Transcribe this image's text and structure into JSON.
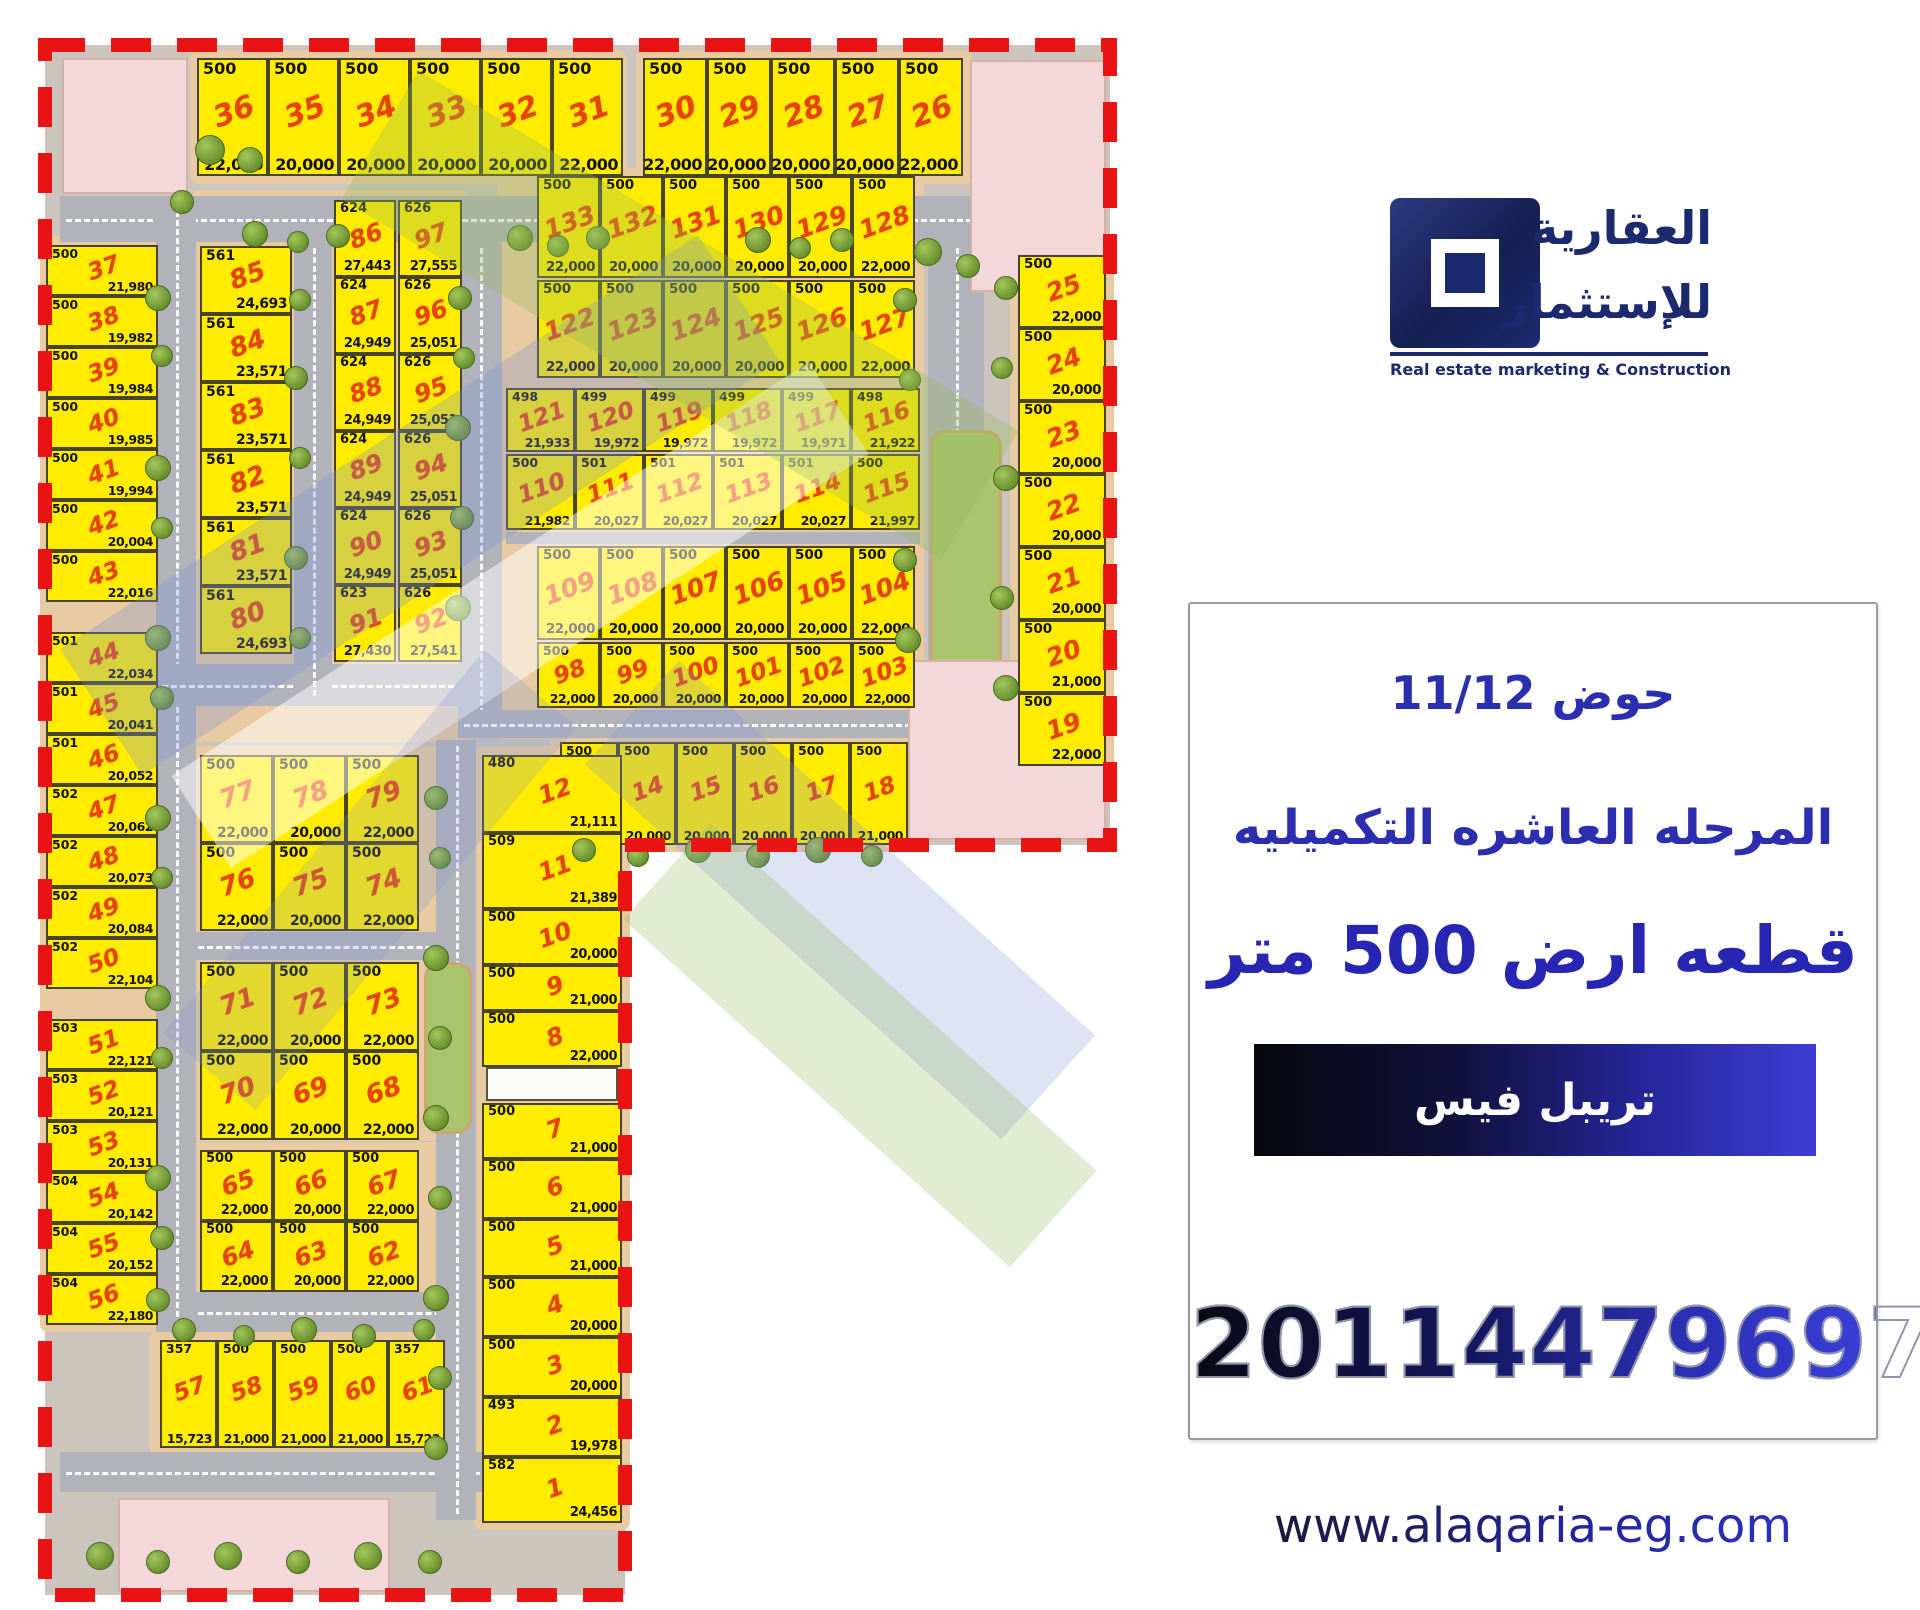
{
  "logo": {
    "arabic_line1": "العقارية",
    "arabic_line2": "للإستثمار",
    "subtitle": "Real estate marketing & Construction"
  },
  "panel": {
    "heading": "حوض 11/12",
    "subheading": "المرحله العاشره التكميليه",
    "plot_size": "قطعه ارض 500 متر",
    "banner_label": "تريبل فيس",
    "phone": "201144796971"
  },
  "footer": {
    "website": "www.alaqaria-eg.com"
  },
  "colors": {
    "plot_fill": "#ffec00",
    "plot_number": "#e8430b",
    "boundary_dash": "#ea1313",
    "road": "#b2b3ba",
    "sidewalk": "#e8cba3",
    "brand_navy": "#1b2a6e",
    "heading_blue": "#2b2eae"
  },
  "map": {
    "groups": [
      {
        "id": "top-row-a",
        "plots": [
          {
            "no": "36",
            "area": "500",
            "price": "22,000"
          },
          {
            "no": "35",
            "area": "500",
            "price": "20,000"
          },
          {
            "no": "34",
            "area": "500",
            "price": "20,000"
          },
          {
            "no": "33",
            "area": "500",
            "price": "20,000"
          },
          {
            "no": "32",
            "area": "500",
            "price": "20,000"
          },
          {
            "no": "31",
            "area": "500",
            "price": "22,000"
          }
        ]
      },
      {
        "id": "top-row-b",
        "plots": [
          {
            "no": "30",
            "area": "500",
            "price": "22,000"
          },
          {
            "no": "29",
            "area": "500",
            "price": "20,000"
          },
          {
            "no": "28",
            "area": "500",
            "price": "20,000"
          },
          {
            "no": "27",
            "area": "500",
            "price": "20,000"
          },
          {
            "no": "26",
            "area": "500",
            "price": "22,000"
          }
        ]
      },
      {
        "id": "left-col",
        "plots": [
          {
            "no": "37",
            "area": "500",
            "price": "21,980"
          },
          {
            "no": "38",
            "area": "500",
            "price": "19,982"
          },
          {
            "no": "39",
            "area": "500",
            "price": "19,984"
          },
          {
            "no": "40",
            "area": "500",
            "price": "19,985"
          },
          {
            "no": "41",
            "area": "500",
            "price": "19,994"
          },
          {
            "no": "42",
            "area": "500",
            "price": "20,004"
          },
          {
            "no": "43",
            "area": "500",
            "price": "22,016"
          },
          {
            "no": "44",
            "area": "501",
            "price": "22,034"
          },
          {
            "no": "45",
            "area": "501",
            "price": "20,041"
          },
          {
            "no": "46",
            "area": "501",
            "price": "20,052"
          },
          {
            "no": "47",
            "area": "502",
            "price": "20,062"
          },
          {
            "no": "48",
            "area": "502",
            "price": "20,073"
          },
          {
            "no": "49",
            "area": "502",
            "price": "20,084"
          },
          {
            "no": "50",
            "area": "502",
            "price": "22,104"
          },
          {
            "no": "51",
            "area": "503",
            "price": "22,121"
          },
          {
            "no": "52",
            "area": "503",
            "price": "20,121"
          },
          {
            "no": "53",
            "area": "503",
            "price": "20,131"
          },
          {
            "no": "54",
            "area": "504",
            "price": "20,142"
          },
          {
            "no": "55",
            "area": "504",
            "price": "20,152"
          },
          {
            "no": "56",
            "area": "504",
            "price": "22,180"
          }
        ]
      },
      {
        "id": "inner-col-1",
        "plots": [
          {
            "no": "85",
            "area": "561",
            "price": "24,693"
          },
          {
            "no": "84",
            "area": "561",
            "price": "23,571"
          },
          {
            "no": "83",
            "area": "561",
            "price": "23,571"
          },
          {
            "no": "82",
            "area": "561",
            "price": "23,571"
          },
          {
            "no": "81",
            "area": "561",
            "price": "23,571"
          },
          {
            "no": "80",
            "area": "561",
            "price": "24,693"
          }
        ]
      },
      {
        "id": "inner-col-2",
        "plots": [
          {
            "no": "86",
            "area": "624",
            "price": "27,443"
          },
          {
            "no": "87",
            "area": "624",
            "price": "24,949"
          },
          {
            "no": "88",
            "area": "624",
            "price": "24,949"
          },
          {
            "no": "89",
            "area": "624",
            "price": "24,949"
          },
          {
            "no": "90",
            "area": "624",
            "price": "24,949"
          },
          {
            "no": "91",
            "area": "623",
            "price": "27,430"
          }
        ]
      },
      {
        "id": "inner-col-3",
        "plots": [
          {
            "no": "97",
            "area": "626",
            "price": "27,555"
          },
          {
            "no": "96",
            "area": "626",
            "price": "25,051"
          },
          {
            "no": "95",
            "area": "626",
            "price": "25,051"
          },
          {
            "no": "94",
            "area": "626",
            "price": "25,051"
          },
          {
            "no": "93",
            "area": "626",
            "price": "25,051"
          },
          {
            "no": "92",
            "area": "626",
            "price": "27,541"
          }
        ]
      },
      {
        "id": "grid-row-1",
        "plots": [
          {
            "no": "133",
            "area": "500",
            "price": "22,000"
          },
          {
            "no": "132",
            "area": "500",
            "price": "20,000"
          },
          {
            "no": "131",
            "area": "500",
            "price": "20,000"
          },
          {
            "no": "130",
            "area": "500",
            "price": "20,000"
          },
          {
            "no": "129",
            "area": "500",
            "price": "20,000"
          },
          {
            "no": "128",
            "area": "500",
            "price": "22,000"
          }
        ]
      },
      {
        "id": "grid-row-2",
        "plots": [
          {
            "no": "122",
            "area": "500",
            "price": "22,000"
          },
          {
            "no": "123",
            "area": "500",
            "price": "20,000"
          },
          {
            "no": "124",
            "area": "500",
            "price": "20,000"
          },
          {
            "no": "125",
            "area": "500",
            "price": "20,000"
          },
          {
            "no": "126",
            "area": "500",
            "price": "20,000"
          },
          {
            "no": "127",
            "area": "500",
            "price": "22,000"
          }
        ]
      },
      {
        "id": "grid-row-3",
        "plots": [
          {
            "no": "121",
            "area": "498",
            "price": "21,933"
          },
          {
            "no": "120",
            "area": "499",
            "price": "19,972"
          },
          {
            "no": "119",
            "area": "499",
            "price": "19,972"
          },
          {
            "no": "118",
            "area": "499",
            "price": "19,972"
          },
          {
            "no": "117",
            "area": "499",
            "price": "19,971"
          },
          {
            "no": "116",
            "area": "498",
            "price": "21,922"
          }
        ]
      },
      {
        "id": "grid-row-4",
        "plots": [
          {
            "no": "110",
            "area": "500",
            "price": "21,982"
          },
          {
            "no": "111",
            "area": "501",
            "price": "20,027"
          },
          {
            "no": "112",
            "area": "501",
            "price": "20,027"
          },
          {
            "no": "113",
            "area": "501",
            "price": "20,027"
          },
          {
            "no": "114",
            "area": "501",
            "price": "20,027"
          },
          {
            "no": "115",
            "area": "500",
            "price": "21,997"
          }
        ]
      },
      {
        "id": "grid-row-5",
        "plots": [
          {
            "no": "109",
            "area": "500",
            "price": "22,000"
          },
          {
            "no": "108",
            "area": "500",
            "price": "20,000"
          },
          {
            "no": "107",
            "area": "500",
            "price": "20,000"
          },
          {
            "no": "106",
            "area": "500",
            "price": "20,000"
          },
          {
            "no": "105",
            "area": "500",
            "price": "20,000"
          },
          {
            "no": "104",
            "area": "500",
            "price": "22,000"
          }
        ]
      },
      {
        "id": "grid-row-6",
        "plots": [
          {
            "no": "98",
            "area": "500",
            "price": "22,000"
          },
          {
            "no": "99",
            "area": "500",
            "price": "20,000"
          },
          {
            "no": "100",
            "area": "500",
            "price": "20,000"
          },
          {
            "no": "101",
            "area": "500",
            "price": "20,000"
          },
          {
            "no": "102",
            "area": "500",
            "price": "20,000"
          },
          {
            "no": "103",
            "area": "500",
            "price": "22,000"
          }
        ]
      },
      {
        "id": "mid-row-13-18",
        "plots": [
          {
            "no": "13",
            "area": "500",
            "price": "20,000"
          },
          {
            "no": "14",
            "area": "500",
            "price": "20,000"
          },
          {
            "no": "15",
            "area": "500",
            "price": "20,000"
          },
          {
            "no": "16",
            "area": "500",
            "price": "20,000"
          },
          {
            "no": "17",
            "area": "500",
            "price": "20,000"
          },
          {
            "no": "18",
            "area": "500",
            "price": "21,000"
          }
        ]
      },
      {
        "id": "right-col-upper",
        "plots": [
          {
            "no": "25",
            "area": "500",
            "price": "22,000"
          },
          {
            "no": "24",
            "area": "500",
            "price": "20,000"
          },
          {
            "no": "23",
            "area": "500",
            "price": "20,000"
          },
          {
            "no": "22",
            "area": "500",
            "price": "20,000"
          },
          {
            "no": "21",
            "area": "500",
            "price": "20,000"
          },
          {
            "no": "20",
            "area": "500",
            "price": "21,000"
          },
          {
            "no": "19",
            "area": "500",
            "price": "22,000"
          }
        ]
      },
      {
        "id": "right-col-lower",
        "plots": [
          {
            "no": "12",
            "area": "480",
            "price": "21,111"
          },
          {
            "no": "11",
            "area": "509",
            "price": "21,389"
          },
          {
            "no": "10",
            "area": "500",
            "price": "20,000"
          },
          {
            "no": "9",
            "area": "500",
            "price": "21,000"
          },
          {
            "no": "8",
            "area": "500",
            "price": "22,000"
          },
          {
            "no": "7",
            "area": "500",
            "price": "21,000"
          },
          {
            "no": "6",
            "area": "500",
            "price": "21,000"
          },
          {
            "no": "5",
            "area": "500",
            "price": "21,000"
          },
          {
            "no": "4",
            "area": "500",
            "price": "20,000"
          },
          {
            "no": "3",
            "area": "500",
            "price": "20,000"
          },
          {
            "no": "2",
            "area": "493",
            "price": "19,978"
          },
          {
            "no": "1",
            "area": "582",
            "price": "24,456"
          }
        ]
      },
      {
        "id": "block-77-74",
        "plots": [
          {
            "no": "77",
            "area": "500",
            "price": "22,000"
          },
          {
            "no": "78",
            "area": "500",
            "price": "20,000"
          },
          {
            "no": "79",
            "area": "500",
            "price": "22,000"
          },
          {
            "no": "76",
            "area": "500",
            "price": "22,000"
          },
          {
            "no": "75",
            "area": "500",
            "price": "20,000"
          },
          {
            "no": "74",
            "area": "500",
            "price": "22,000"
          }
        ]
      },
      {
        "id": "block-71-68",
        "plots": [
          {
            "no": "71",
            "area": "500",
            "price": "22,000"
          },
          {
            "no": "72",
            "area": "500",
            "price": "20,000"
          },
          {
            "no": "73",
            "area": "500",
            "price": "22,000"
          },
          {
            "no": "70",
            "area": "500",
            "price": "22,000"
          },
          {
            "no": "69",
            "area": "500",
            "price": "20,000"
          },
          {
            "no": "68",
            "area": "500",
            "price": "22,000"
          }
        ]
      },
      {
        "id": "block-65-62",
        "plots": [
          {
            "no": "65",
            "area": "500",
            "price": "22,000"
          },
          {
            "no": "66",
            "area": "500",
            "price": "20,000"
          },
          {
            "no": "67",
            "area": "500",
            "price": "22,000"
          },
          {
            "no": "64",
            "area": "500",
            "price": "22,000"
          },
          {
            "no": "63",
            "area": "500",
            "price": "20,000"
          },
          {
            "no": "62",
            "area": "500",
            "price": "22,000"
          }
        ]
      },
      {
        "id": "bottom-row",
        "plots": [
          {
            "no": "57",
            "area": "357",
            "price": "15,723"
          },
          {
            "no": "58",
            "area": "500",
            "price": "21,000"
          },
          {
            "no": "59",
            "area": "500",
            "price": "21,000"
          },
          {
            "no": "60",
            "area": "500",
            "price": "21,000"
          },
          {
            "no": "61",
            "area": "357",
            "price": "15,723"
          }
        ]
      }
    ]
  }
}
